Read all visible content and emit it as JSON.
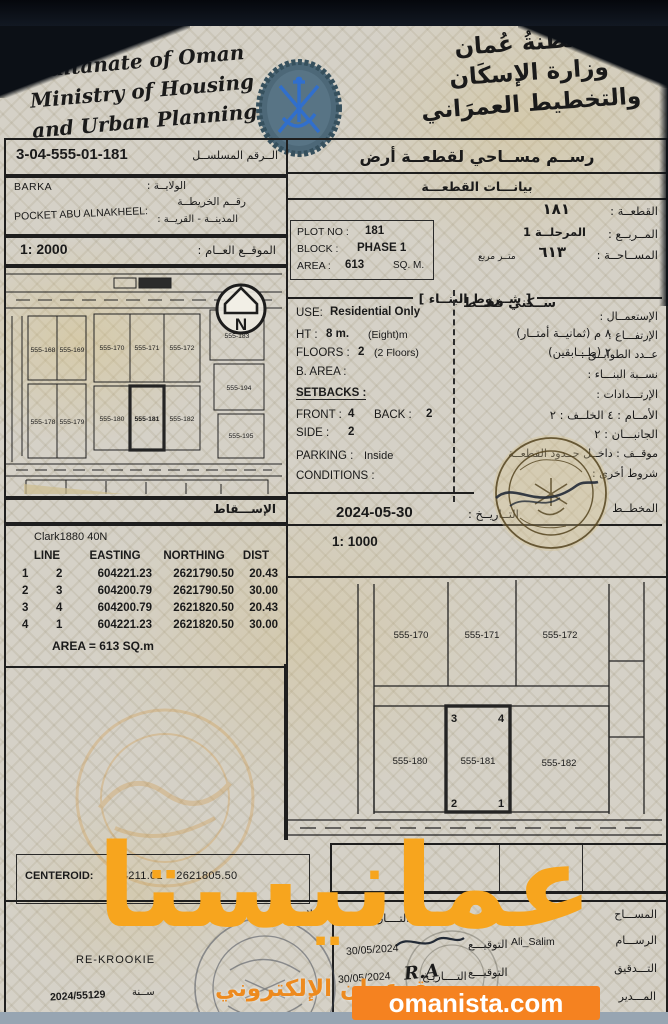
{
  "header": {
    "en1": "Sultanate of Oman",
    "en2": "Ministry of Housing",
    "en3": "and Urban Planning",
    "ar1": "سلطنةُ عُمان",
    "ar2": "وزارة الإسكَان",
    "ar3": "والتخطيط العمرَاني"
  },
  "serial": {
    "value": "3-04-555-01-181",
    "label_ar": "الــرقم المسلســل"
  },
  "location": {
    "wilaya": "BARKA",
    "wilaya_label_ar": "الولايــة :",
    "village": "POCKET ABU ALNAKHEEL:",
    "map_no_label_ar": "رقــم الخريطــة",
    "village_label_ar": "المدينــة - القريــة :"
  },
  "site": {
    "scale": "1: 2000",
    "label_ar": "الموقــع العــام :"
  },
  "right": {
    "title_ar": "رســم مســاحي لقطعــة أرض",
    "subtitle_ar": "بيانـــات القطعـــة"
  },
  "plot": {
    "plot_no_label": "PLOT NO :",
    "plot_no": "181",
    "plot_ar": "١٨١",
    "plot_label_ar": "القطعــة :",
    "block_label": "BLOCK :",
    "block": "PHASE 1",
    "block_ar": "المرحلــة 1",
    "block_label_ar": "المــربــع :",
    "area_label": "AREA :",
    "area": "613",
    "area_unit": "SQ. M.",
    "area_ar": "٦١٣",
    "area_unit_ar": "متــر مربع",
    "area_label_ar": "المســاحــة :"
  },
  "building": {
    "title_ar": "[ شــروط البنــاء ]",
    "use_label": "USE:",
    "use": "Residential Only",
    "use_ar": "ســكني فقــط",
    "use_label_ar": "الإستعمــال :",
    "ht_label": "HT :",
    "ht": "8 m.",
    "ht_note": "(Eight)m",
    "ht_ar_line": "٨   م   (ثمانيــة أمتــار)",
    "ht_label_ar": "الإرتفـــاع :",
    "floors_label": "FLOORS :",
    "floors": "2",
    "floors_note": "(2 Floors)",
    "floors_ar_line": "٢   (طـــابقين)",
    "floors_label_ar": "عــدد الطوابــق :",
    "barea_label": "B. AREA :",
    "barea_label_ar": "نســبة البنـــاء :",
    "setbacks_label": "SETBACKS :",
    "setbacks_label_ar": "الإرتـــدادات :",
    "front_label": "FRONT :",
    "front": "4",
    "back_label": "BACK :",
    "back": "2",
    "front_back_ar": "الأمــام : ٤     الخلــف : ٢",
    "side_label": "SIDE :",
    "side": "2",
    "side_ar": "الجانبـــان : ٢",
    "parking_label": "PARKING :",
    "parking": "Inside",
    "parking_ar": "موقــف :   داخــل حــدود القطعــة",
    "conditions_label": "CONDITIONS :",
    "other_ar": "شروط أخرى :"
  },
  "footer_dates": {
    "survey_date": "2024-05-30",
    "date_label_ar": "التــاريــخ :",
    "planner_label_ar": "المخطــط",
    "detail_scale": "1: 1000"
  },
  "projection": {
    "label_ar": "الإســـقاط",
    "datum": "Clark1880 40N"
  },
  "coords": {
    "headers": {
      "line": "LINE",
      "easting": "EASTING",
      "northing": "NORTHING",
      "dist": "DIST"
    },
    "rows": [
      [
        "1",
        "2",
        "604221.23",
        "2621790.50",
        "20.43"
      ],
      [
        "2",
        "3",
        "604200.79",
        "2621790.50",
        "30.00"
      ],
      [
        "3",
        "4",
        "604200.79",
        "2621820.50",
        "20.43"
      ],
      [
        "4",
        "1",
        "604221.23",
        "2621820.50",
        "30.00"
      ]
    ],
    "area_line": "AREA = 613  SQ.m"
  },
  "map1": {
    "r1a": [
      "555-168",
      "555-169"
    ],
    "r1b": [
      "555-170",
      "555-171",
      "555-172"
    ],
    "right_col": [
      "555-183",
      "555-194",
      "555-195"
    ],
    "r2a": [
      "555-178",
      "555-179"
    ],
    "r2b": [
      "555-180",
      "555-181",
      "555-182"
    ]
  },
  "map2": {
    "top": [
      "555-170",
      "555-171",
      "555-172"
    ],
    "bottom": [
      "555-180",
      "555-181",
      "555-182"
    ],
    "corners": {
      "tl": "3",
      "tr": "4",
      "bl": "2",
      "br": "1"
    }
  },
  "compass": {
    "letter": "N"
  },
  "centeroid": {
    "label": "CENTEROID:",
    "value": "604211.01    2621805.50"
  },
  "notes": {
    "label_ar": "الملاحظــات :",
    "value": "RE-KROOKIE",
    "ref": "2024/55129",
    "ref_label_ar": "ســنة"
  },
  "sig": {
    "sign_ar": "التوقيـــع",
    "date_ar": "التــــاريـخ",
    "date_short_ar": "التــــار",
    "surveyor_ar": "المســـاح",
    "draftsman_ar": "الرســـام",
    "draftsman_name": "Ali_Salim",
    "draftsman_date": "30/05/2024",
    "audit_ar": "التـــدقيق",
    "audit_sign": "R.A",
    "audit_date": "30/05/2024",
    "manager_ar": "المـــدير"
  },
  "watermark": {
    "big": "عمانيستا",
    "sub": "سوق عمان الإلكتروني",
    "site": "omanista.com"
  },
  "colors": {
    "accent_orange": "#F58220",
    "watermark_orange": "#F7A51E",
    "stamp_olive": "#53431F",
    "emblem_blue": "#2F6FD0"
  }
}
